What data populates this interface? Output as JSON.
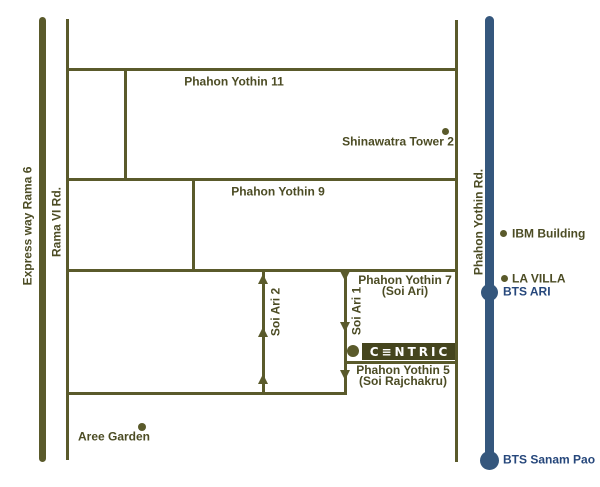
{
  "colors": {
    "road_olive": "#5a5a2b",
    "label_olive": "#4c4c24",
    "bts_blue": "#35577d",
    "bts_label_blue": "#26477b",
    "logo_bg": "#45451e",
    "logo_text": "#ffffff"
  },
  "roads": {
    "expressway": "Express way Rama 6",
    "rama_vi": "Rama VI Rd.",
    "phahon_yothin_11": "Phahon Yothin 11",
    "phahon_yothin_9": "Phahon Yothin 9",
    "phahon_yothin_7": "Phahon Yothin 7",
    "phahon_yothin_7_sub": "(Soi Ari)",
    "phahon_yothin_5": "Phahon Yothin 5",
    "phahon_yothin_5_sub": "(Soi Rajchakru)",
    "soi_ari_1": "Soi Ari 1",
    "soi_ari_2": "Soi Ari 2",
    "phahon_yothin_rd": "Phahon Yothin Rd."
  },
  "landmarks": {
    "shinawatra_tower": "Shinawatra Tower 2",
    "ibm_building": "IBM Building",
    "la_villa": "LA VILLA",
    "bts_ari": "BTS ARI",
    "bts_sanam_pao": "BTS Sanam Pao",
    "aree_garden": "Aree Garden"
  },
  "logo": {
    "text": "C≡NTRIC"
  }
}
